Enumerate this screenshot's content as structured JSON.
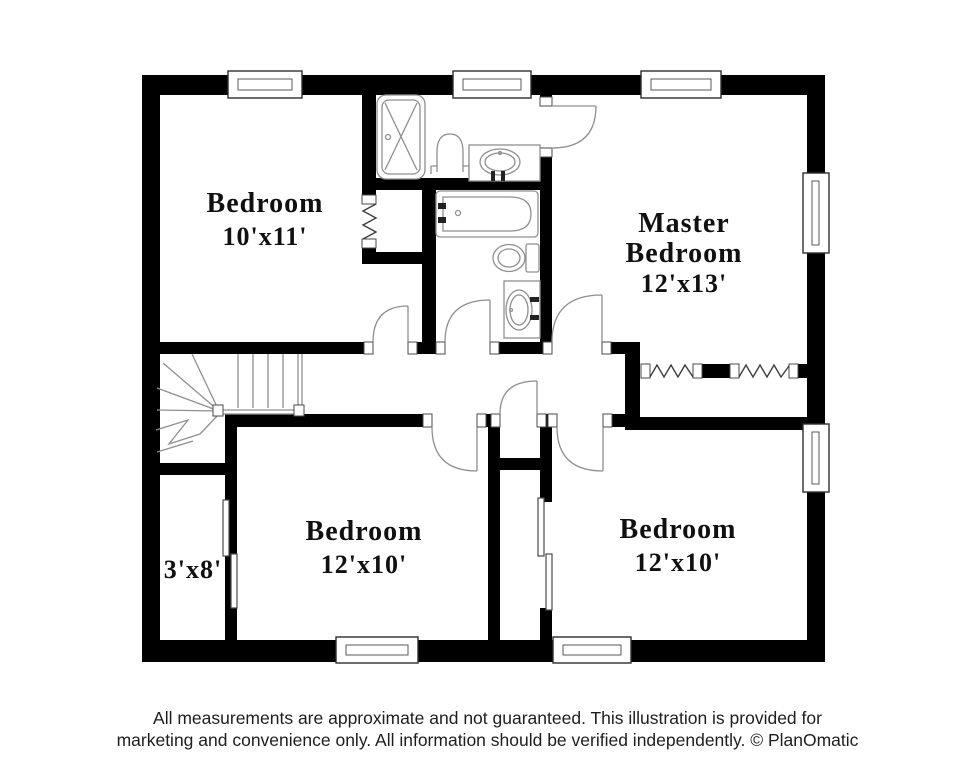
{
  "colors": {
    "wall": "#000000",
    "line": "#8f8f8f",
    "label": "#101010",
    "footer": "#1e1e1e"
  },
  "plan": {
    "rooms": [
      {
        "name": "Bedroom",
        "dims": "10'x11'"
      },
      {
        "name_line1": "Master",
        "name_line2": "Bedroom",
        "dims": "12'x13'"
      },
      {
        "dims": "3'x8'"
      },
      {
        "name": "Bedroom",
        "dims": "12'x10'"
      },
      {
        "name": "Bedroom",
        "dims": "12'x10'"
      }
    ],
    "fixtures": {
      "upper_bathroom": [
        "shower",
        "toilet",
        "sink"
      ],
      "lower_bathroom": [
        "bathtub",
        "toilet",
        "sink"
      ]
    },
    "features": [
      "stairs",
      "accordion-closet-doors",
      "sliding-closet-doors",
      "linen-closet",
      "windows"
    ]
  },
  "footer": {
    "line1": "All measurements are approximate and not guaranteed. This illustration is provided for",
    "line2": "marketing and convenience only. All information should be verified independently. © PlanOmatic"
  }
}
